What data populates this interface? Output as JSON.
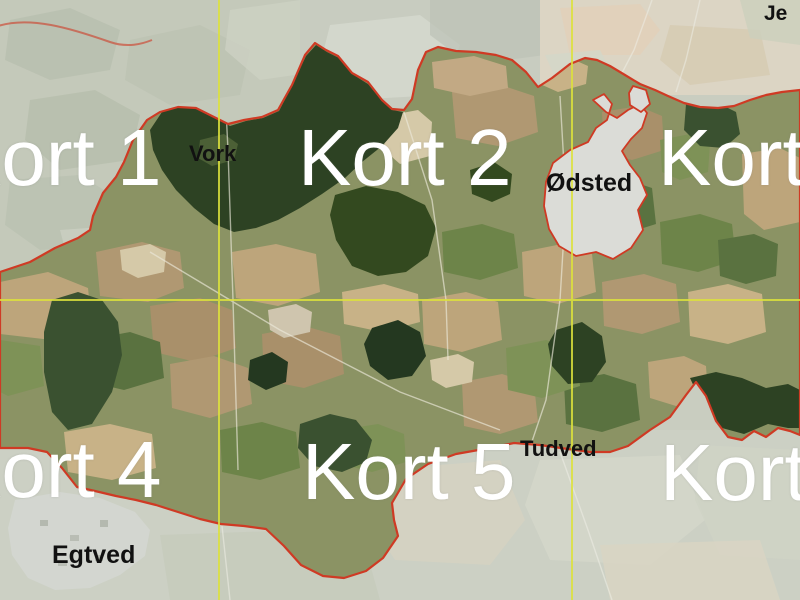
{
  "map": {
    "kort_labels": [
      {
        "id": "kort-1",
        "text": "Kort 1"
      },
      {
        "id": "kort-2",
        "text": "Kort 2"
      },
      {
        "id": "kort-3",
        "text": "Kort"
      },
      {
        "id": "kort-4",
        "text": "Kort 4"
      },
      {
        "id": "kort-5",
        "text": "Kort 5"
      },
      {
        "id": "kort-6",
        "text": "Kort"
      }
    ],
    "place_labels": [
      {
        "id": "vork",
        "text": "Vork"
      },
      {
        "id": "odsted",
        "text": "Ødsted"
      },
      {
        "id": "tudved",
        "text": "Tudved"
      },
      {
        "id": "egtved",
        "text": "Egtved"
      },
      {
        "id": "jerlev-partial",
        "text": "Je"
      }
    ],
    "colors": {
      "boundary_red": "#cf3a24",
      "grid_yellow": "#dde23c",
      "sheet_label_white": "#ffffff",
      "place_label_black": "#111111",
      "town_fill": "#dbdcd7"
    }
  }
}
